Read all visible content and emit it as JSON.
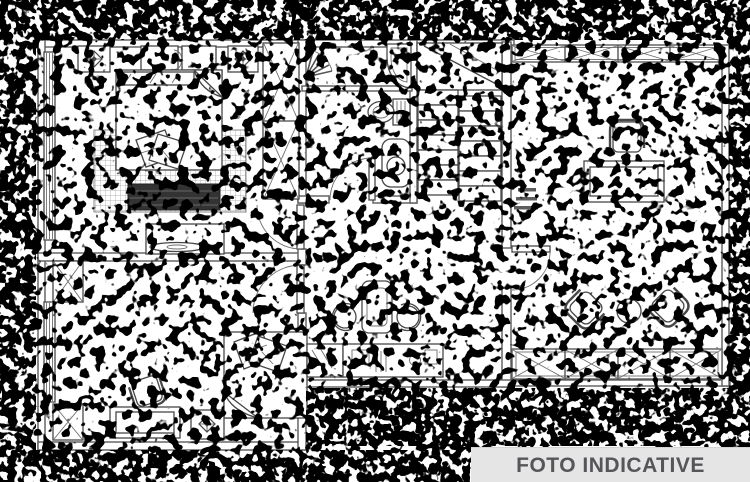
{
  "meta": {
    "kind": "apartment floor plan scan, binarized with heavy black speckle noise",
    "width": 750,
    "height": 482
  },
  "banner": {
    "label": "FOTO INDICATIVE",
    "background": "#e5e5e5",
    "text_color": "#55555a"
  },
  "palette": {
    "page_background": "#ffffff",
    "wall_line": "#5b5b5b",
    "furniture_line": "#474747",
    "noise": "#000000",
    "rug_grid": "#9b9b9b",
    "ottoman_fill": "#333333"
  },
  "plan": {
    "rooms": [
      {
        "name": "bedroom-top-left",
        "items": [
          "double bed with folded sheet corner",
          "headboard cushions",
          "two nightstands with lamp symbols",
          "wardrobe with two crossed panels",
          "gridded rug",
          "dark ottoman bench",
          "tv console"
        ]
      },
      {
        "name": "bathroom",
        "items": [
          "radiating fan symbol",
          "corner basin",
          "bidet",
          "pedestal washbasin",
          "door arc"
        ]
      },
      {
        "name": "staircase",
        "items": [
          "upper landing with diagonal break line",
          "two flights of seven treads"
        ]
      },
      {
        "name": "bedroom-bottom-left",
        "items": [
          "bed with decorative pillows and folded sheet corner",
          "desk",
          "chair",
          "nightstand with lamp symbol",
          "two crossed wardrobe modules",
          "door arc"
        ]
      },
      {
        "name": "kitchen-dining",
        "items": [
          "oval table",
          "two stools",
          "kitchen counter with sink"
        ]
      },
      {
        "name": "study-living",
        "items": [
          "desk",
          "office chair",
          "tiny illegible measurement label",
          "two corner armchairs",
          "round side table",
          "door arc"
        ]
      },
      {
        "name": "terrace",
        "items": [
          "top railing with four crossed panels",
          "bottom railing with four crossed panels"
        ]
      }
    ]
  }
}
